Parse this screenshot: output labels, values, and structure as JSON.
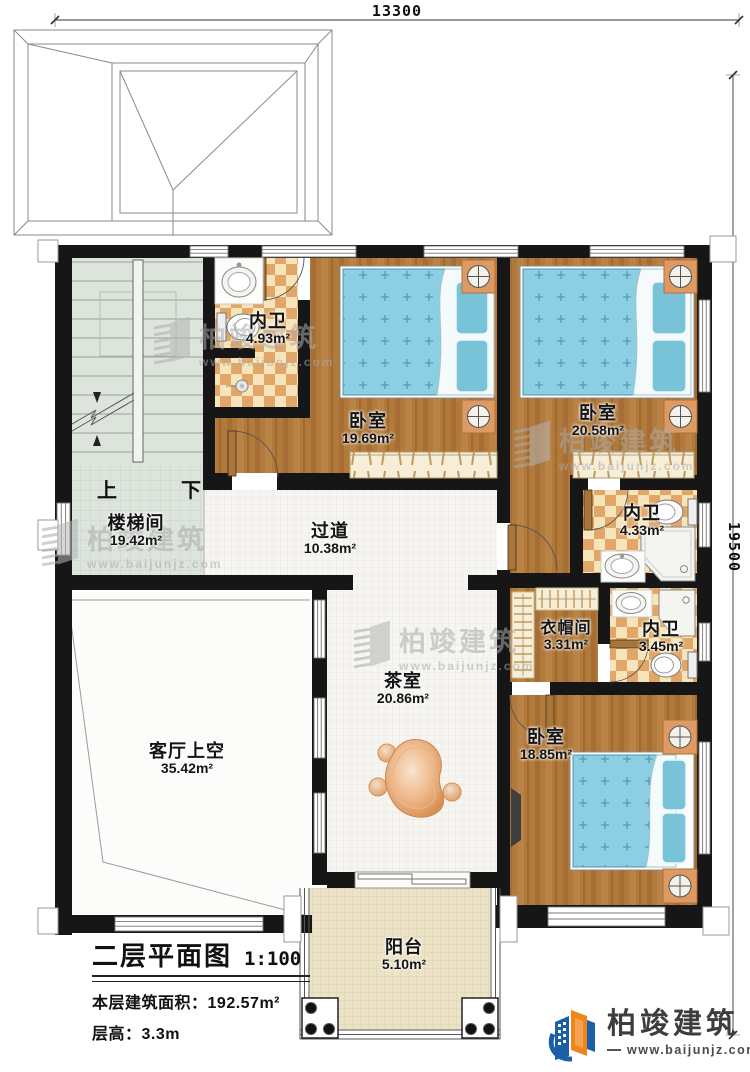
{
  "plan": {
    "dimension_width": "13300",
    "dimension_height": "19500"
  },
  "rooms": [
    {
      "name": "内卫",
      "area": "4.93m²"
    },
    {
      "name": "卧室",
      "area": "19.69m²"
    },
    {
      "name": "卧室",
      "area": "20.58m²"
    },
    {
      "name": "内卫",
      "area": "4.33m²"
    },
    {
      "name": "衣帽间",
      "area": "3.31m²"
    },
    {
      "name": "内卫",
      "area": "3.45m²"
    },
    {
      "name": "卧室",
      "area": "18.85m²"
    },
    {
      "name": "过道",
      "area": "10.38m²"
    },
    {
      "name": "茶室",
      "area": "20.86m²"
    },
    {
      "name": "楼梯间",
      "area": "19.42m²"
    },
    {
      "name": "客厅上空",
      "area": "35.42m²"
    },
    {
      "name": "阳台",
      "area": "5.10m²"
    }
  ],
  "stairs": {
    "up_label": "上",
    "down_label": "下"
  },
  "title_block": {
    "title": "二层平面图",
    "scale": "1:100",
    "floor_area_label": "本层建筑面积：",
    "floor_area_value": "192.57m²",
    "floor_height_label": "层高：",
    "floor_height_value": "3.3m"
  },
  "watermark": {
    "brand": "柏竣建筑",
    "website": "www.baijunjz.com"
  },
  "logo": {
    "brand": "柏竣建筑",
    "website": "www.baijunjz.com"
  },
  "colors": {
    "wall": "#161616",
    "wood": "#b1793c",
    "tile": "#e2a768",
    "bed": "#8ccfe2",
    "stair": "#dce4db",
    "balcony": "#ece3c6",
    "logo_blue": "#1b5fa6",
    "logo_orange": "#f08519"
  }
}
